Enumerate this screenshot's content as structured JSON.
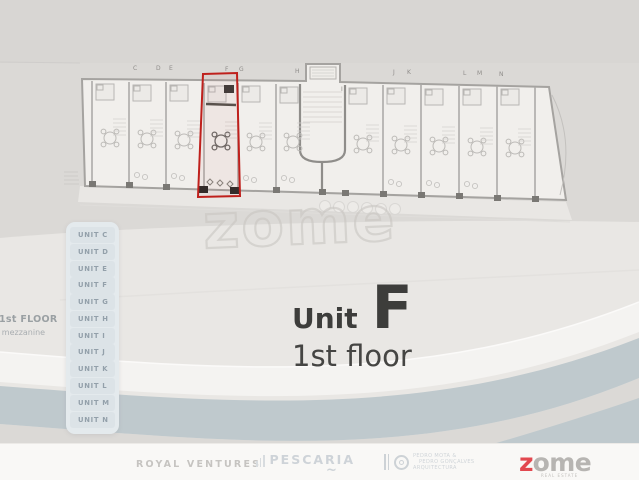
{
  "watermark": "zome",
  "sidebar": {
    "items": [
      "UNIT C",
      "UNIT D",
      "UNIT E",
      "UNIT F",
      "UNIT G",
      "UNIT H",
      "UNIT I",
      "UNIT J",
      "UNIT K",
      "UNIT L",
      "UNIT M",
      "UNIT N"
    ]
  },
  "floor_label": {
    "line1": "1st FLOOR",
    "line2": "& mezzanine"
  },
  "title": {
    "word": "Unit",
    "letter": "F",
    "floor": "1st floor"
  },
  "plan": {
    "highlighted_unit": "F",
    "letters": [
      {
        "ch": "C",
        "x": 133,
        "y": 70
      },
      {
        "ch": "D",
        "x": 156,
        "y": 70
      },
      {
        "ch": "E",
        "x": 169,
        "y": 70
      },
      {
        "ch": "F",
        "x": 225,
        "y": 71
      },
      {
        "ch": "G",
        "x": 239,
        "y": 71
      },
      {
        "ch": "H",
        "x": 295,
        "y": 73
      },
      {
        "ch": "I",
        "x": 341,
        "y": 91
      },
      {
        "ch": "J",
        "x": 393,
        "y": 74
      },
      {
        "ch": "K",
        "x": 407,
        "y": 74
      },
      {
        "ch": "L",
        "x": 463,
        "y": 75
      },
      {
        "ch": "M",
        "x": 477,
        "y": 75
      },
      {
        "ch": "N",
        "x": 499,
        "y": 76
      }
    ]
  },
  "footer": {
    "royal": "ROYAL VENTURES",
    "pescaria": "PESCARIA",
    "pescaria_tilde": "~",
    "arch_lines": [
      "PEDRO MOTA &",
      "PEDRO GONÇALVES",
      "ARQUITECTURA"
    ],
    "zome_z": "z",
    "zome_rest": "ome",
    "zome_sub": "REAL ESTATE"
  },
  "colors": {
    "highlight_red": "#bf201c",
    "zome_red": "#e2484f",
    "road_blue": "#bfc9cd",
    "plan_paper": "#f1efec",
    "sidebar_text": "#93a0aa"
  }
}
